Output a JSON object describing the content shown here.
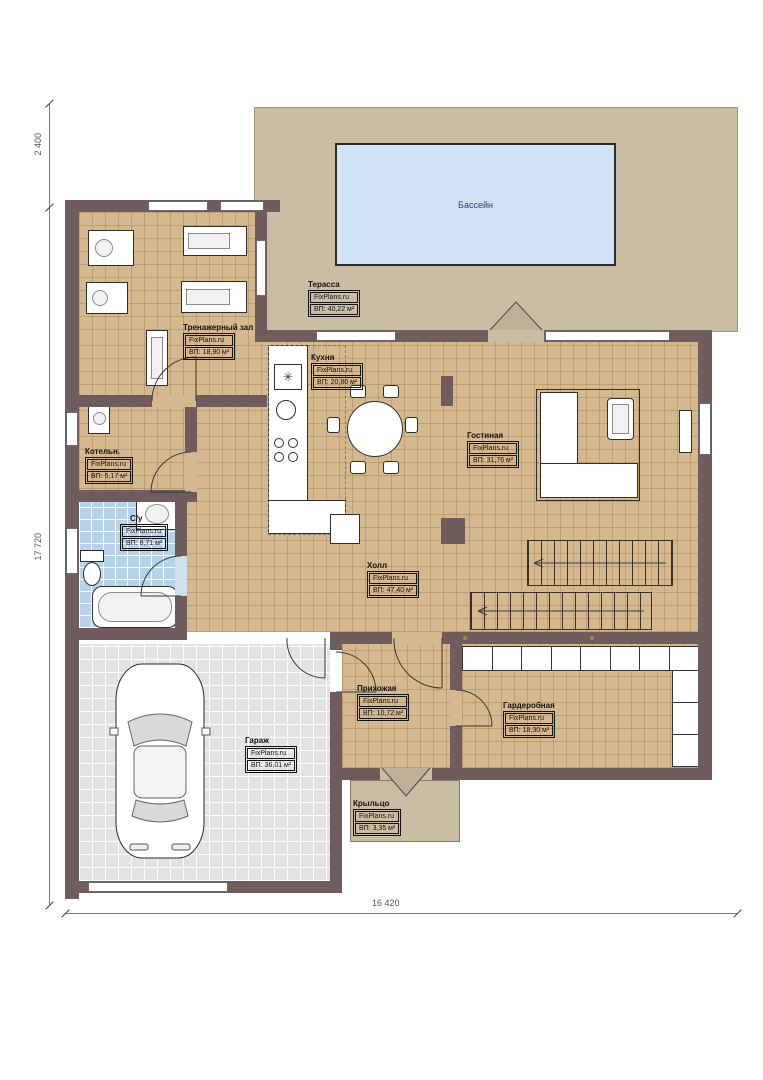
{
  "plan": {
    "pool_label": "Бассейн",
    "dimensions": {
      "top_left": "2 400",
      "left": "17 720",
      "bottom": "16 420"
    }
  },
  "rooms": {
    "terrace": {
      "name": "Терасса",
      "source": "FixPlans.ru",
      "area": "ВП: 40,22 м²"
    },
    "gym": {
      "name": "Тренажерный зал",
      "source": "FixPlans.ru",
      "area": "ВП: 18,90 м²"
    },
    "kitchen": {
      "name": "Кухня",
      "source": "FixPlans.ru",
      "area": "ВП: 20,80 м²"
    },
    "living": {
      "name": "Гостиная",
      "source": "FixPlans.ru",
      "area": "ВП: 31,76 м²"
    },
    "boiler": {
      "name": "Котельн.",
      "source": "FixPlans.ru",
      "area": "ВП: 5,17 м²"
    },
    "bathroom": {
      "name": "С/у",
      "source": "FixPlans.ru",
      "area": "ВП: 8,71 м²"
    },
    "hall": {
      "name": "Холл",
      "source": "FixPlans.ru",
      "area": "ВП: 47,40 м²"
    },
    "entry": {
      "name": "Прихожая",
      "source": "FixPlans.ru",
      "area": "ВП: 10,72 м²"
    },
    "wardrobe": {
      "name": "Гардеробная",
      "source": "FixPlans.ru",
      "area": "ВП: 18,30 м²"
    },
    "garage": {
      "name": "Гараж",
      "source": "FixPlans.ru",
      "area": "ВП: 36,01 м²"
    },
    "porch": {
      "name": "Крыльцо",
      "source": "FixPlans.ru",
      "area": "ВП: 3,35 м²"
    }
  },
  "icons": {
    "fridge_glyph": "✳"
  },
  "colors": {
    "wall": "#6f5d5d",
    "floor_tile": "#d3b98d",
    "tile_grid": "#96603c",
    "terrace": "#c9bda3",
    "pool_water": "#cfe3f5",
    "bathroom_tile": "#b8d3e9",
    "garage_floor": "#e3e3e3",
    "label_text": "#141414",
    "dimension_text": "#555555"
  }
}
